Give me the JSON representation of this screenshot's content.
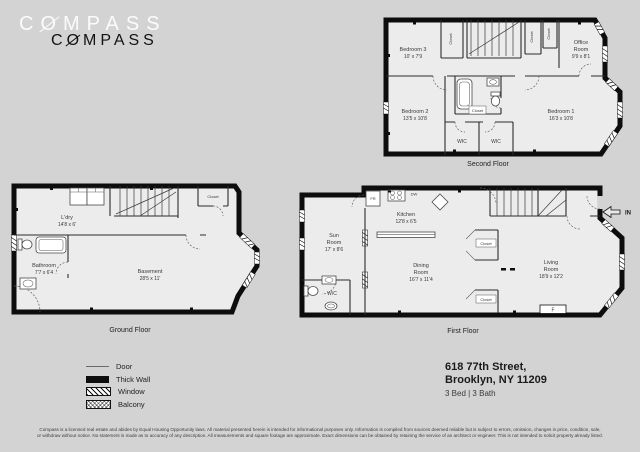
{
  "logo": {
    "part1": "C",
    "o": "O",
    "part3": "MPASS"
  },
  "labels": {
    "closet": "Closet",
    "wic": "WIC"
  },
  "floors": {
    "second": {
      "label": "Second Floor",
      "bedroom3_name": "Bedroom 3",
      "bedroom3_dims": "10' x 7'9",
      "bedroom2_name": "Bedroom 2",
      "bedroom2_dims": "13'5 x 10'8",
      "bedroom1_name": "Bedroom 1",
      "bedroom1_dims": "16'3 x 10'8",
      "office_line1": "Office",
      "office_line2": "Room",
      "office_dims": "9'9 x 8'1"
    },
    "ground": {
      "label": "Ground Floor",
      "laundry_name": "L'dry",
      "laundry_dims": "14'8 x 6'",
      "bathroom_name": "Bathroom",
      "bathroom_dims": "7'7 x 6'4",
      "basement_name": "Basement",
      "basement_dims": "28'5 x 11'"
    },
    "first": {
      "label": "First Floor",
      "kitchen_name": "Kitchen",
      "kitchen_dims": "12'8 x 6'5",
      "sunroom_line1": "Sun",
      "sunroom_line2": "Room",
      "sunroom_dims": "17' x 8'6",
      "dining_line1": "Dining",
      "dining_line2": "Room",
      "dining_dims": "16'7 x 11'4",
      "living_line1": "Living",
      "living_line2": "Room",
      "living_dims": "18'9 x 12'2",
      "wc": "W/C",
      "fr": "FR",
      "dw": "DW",
      "fireplace": "F",
      "entry": "IN"
    }
  },
  "legend": {
    "door": "Door",
    "thick_wall": "Thick Wall",
    "window": "Window",
    "balcony": "Balcony"
  },
  "address": {
    "line1": "618 77th Street,",
    "line2": "Brooklyn, NY 11209",
    "beds_baths": "3 Bed | 3 Bath"
  },
  "disclaimer": {
    "line1": "Compass is a licensed real estate and abides by Equal Housing Opportunity laws. All material presented herein is intended for informational purposes only. Information is compiled from sources deemed reliable but is subject to errors, omission, changes in price, condition, sale,",
    "line2": "or withdraw without notice. No statement is made as to accuracy of any description. All measurements and square footage are approximate. Exact dimensions can be obtained by retaining the service of an architect or engineer. This is not intended to solicit property already listed."
  }
}
